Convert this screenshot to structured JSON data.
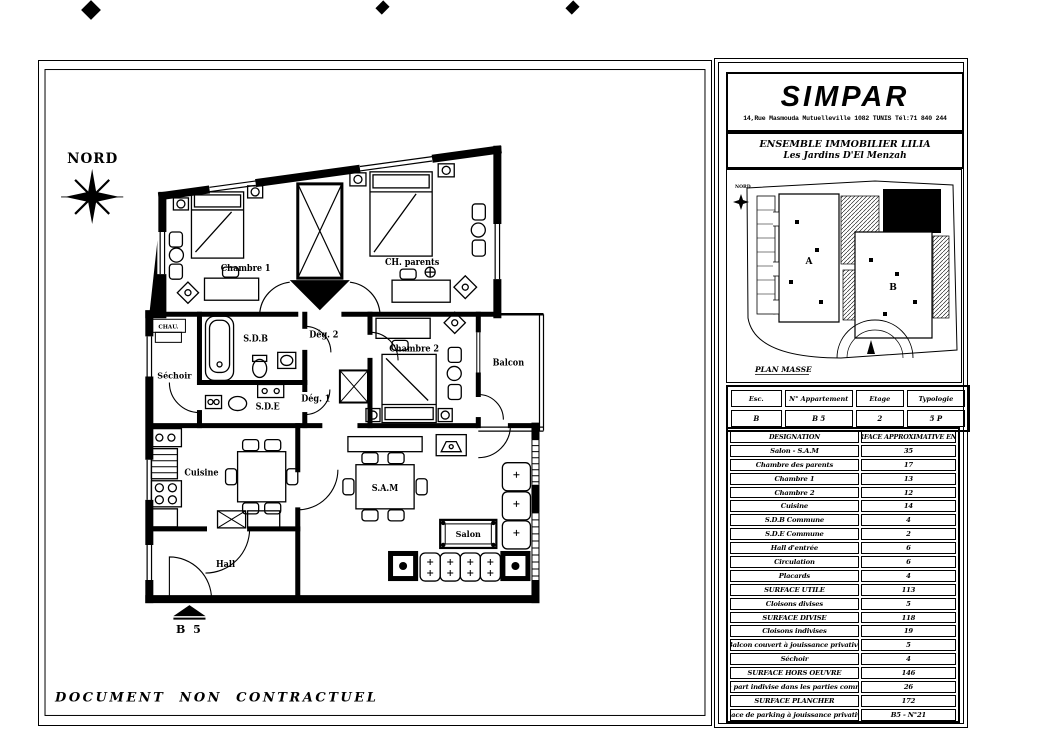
{
  "sheet": {
    "disclaimer": "DOCUMENT NON CONTRACTUEL"
  },
  "plan": {
    "north_label": "NORD",
    "entrance_label": "B 5",
    "rooms": {
      "chambre1": "Chambre 1",
      "ch_parents": "CH. parents",
      "deg2": "Dég. 2",
      "sdb": "S.D.B",
      "sechoir": "Séchoir",
      "sde": "S.D.E",
      "deg1": "Dég. 1",
      "chambre2": "Chambre 2",
      "balcon": "Balcon",
      "cuisine": "Cuisine",
      "sam": "S.A.M",
      "salon": "Salon",
      "hall": "Hall",
      "chau": "CHAU."
    }
  },
  "company": {
    "name": "SIMPAR",
    "address": "14,Rue Masmouda Mutuelleville 1082 TUNIS Tél:71 840 244"
  },
  "project": {
    "title": "ENSEMBLE IMMOBILIER LILIA",
    "subtitle": "Les Jardins D'El Menzah"
  },
  "plan_masse": {
    "label": "PLAN MASSE",
    "north_label": "NORD",
    "block_a_label": "A",
    "block_b_label": "B"
  },
  "apartment_info": {
    "headers": [
      "Esc.",
      "N° Appartement",
      "Etage",
      "Typologie"
    ],
    "values": [
      "B",
      "B 5",
      "2",
      "5 P"
    ]
  },
  "surface_table": {
    "header": {
      "designation": "DESIGNATION",
      "surface": "SURFACE APPROXIMATIVE EN M²"
    },
    "rows": [
      {
        "label": "Salon - S.A.M",
        "value": "35"
      },
      {
        "label": "Chambre des parents",
        "value": "17"
      },
      {
        "label": "Chambre 1",
        "value": "13"
      },
      {
        "label": "Chambre 2",
        "value": "12"
      },
      {
        "label": "Cuisine",
        "value": "14"
      },
      {
        "label": "S.D.B Commune",
        "value": "4"
      },
      {
        "label": "S.D.E Commune",
        "value": "2"
      },
      {
        "label": "Hall d'entrée",
        "value": "6"
      },
      {
        "label": "Circulation",
        "value": "6"
      },
      {
        "label": "Placards",
        "value": "4"
      },
      {
        "label": "SURFACE UTILE",
        "value": "113"
      },
      {
        "label": "Cloisons divises",
        "value": "5"
      },
      {
        "label": "SURFACE DIVISE",
        "value": "118"
      },
      {
        "label": "Cloisons indivises",
        "value": "19"
      },
      {
        "label": "Balcon couvert à jouissance privative",
        "value": "5"
      },
      {
        "label": "Séchoir",
        "value": "4"
      },
      {
        "label": "SURFACE HORS OEUVRE",
        "value": "146"
      },
      {
        "label": "Quote part indivise dans les parties communes",
        "value": "26"
      },
      {
        "label": "SURFACE PLANCHER",
        "value": "172"
      },
      {
        "label": "Place de parking à jouissance privative",
        "value": "B5 - N°21"
      }
    ]
  },
  "colors": {
    "ink": "#000000",
    "paper": "#ffffff"
  }
}
